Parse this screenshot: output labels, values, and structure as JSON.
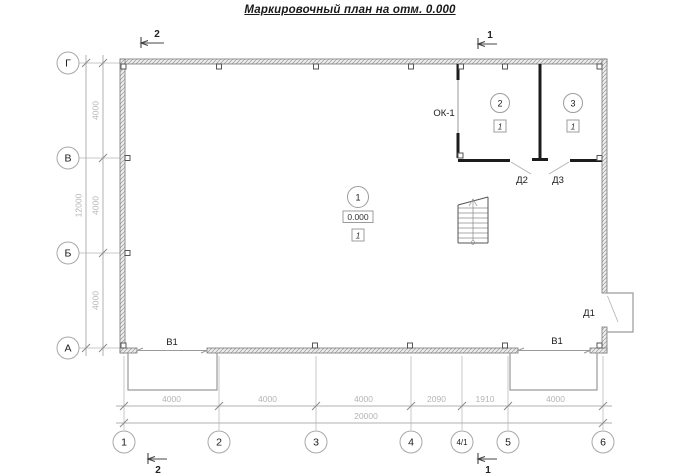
{
  "title": "Маркировочный план на отм. 0.000",
  "axes": {
    "rows": [
      "Г",
      "В",
      "Б",
      "А"
    ],
    "cols": [
      "1",
      "2",
      "3",
      "4",
      "4/1",
      "5",
      "6"
    ]
  },
  "dims": {
    "left_segments": [
      "4000",
      "4000",
      "4000"
    ],
    "left_total": "12000",
    "bottom_segments": [
      "4000",
      "4000",
      "4000",
      "2090",
      "1910",
      "4000"
    ],
    "bottom_total": "20000"
  },
  "sections": {
    "top_left": "2",
    "top_right": "1",
    "bottom_left": "2",
    "bottom_right": "1"
  },
  "rooms": {
    "hall": {
      "number": "1",
      "elevation": "0.000",
      "floor": "1"
    },
    "room2": {
      "number": "2",
      "floor": "1"
    },
    "room3": {
      "number": "3",
      "floor": "1"
    }
  },
  "openings": {
    "window": "ОК-1",
    "door_exterior": "Д1",
    "door_room2": "Д2",
    "door_room3": "Д3",
    "gate_left": "В1",
    "gate_right": "В1"
  },
  "colors": {
    "background": "#ffffff",
    "wall_hatch": "#9b9b9b",
    "partition": "#1c1c1c",
    "dimension": "#b4b4b4",
    "text": "#1a1a1a"
  }
}
